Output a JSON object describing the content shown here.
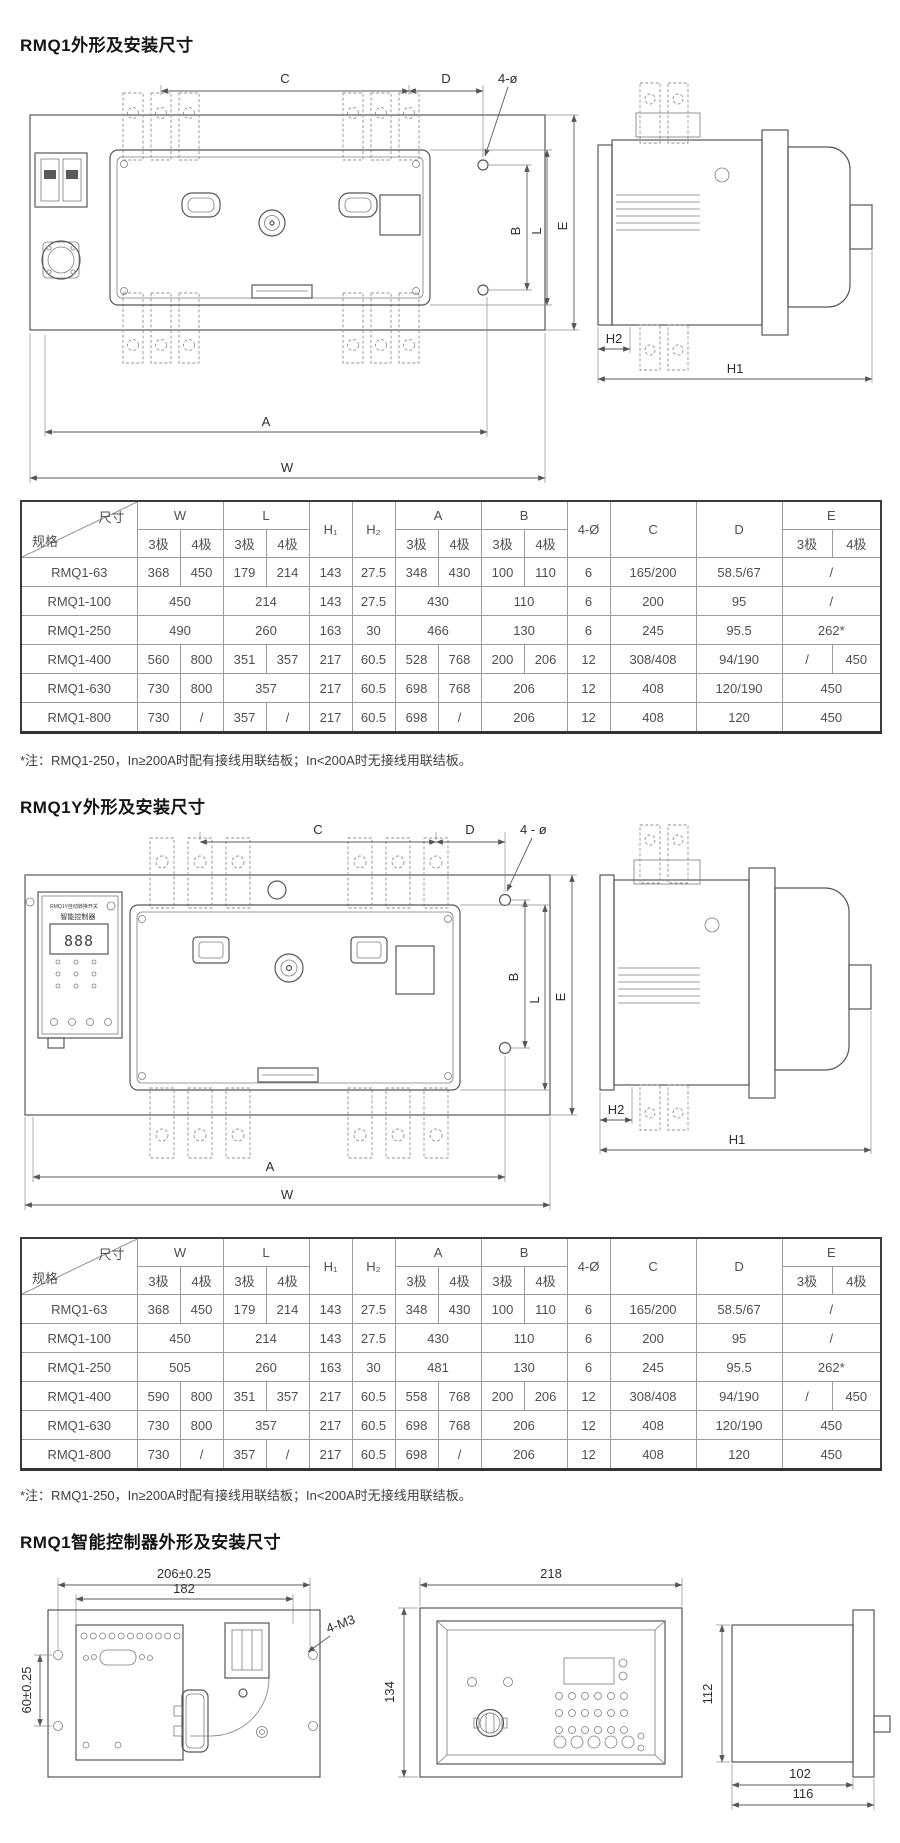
{
  "titles": {
    "section1": "RMQ1外形及安装尺寸",
    "section2": "RMQ1Y外形及安装尺寸",
    "section3": "RMQ1智能控制器外形及安装尺寸"
  },
  "notes": {
    "note1": "*注：RMQ1-250，In≥200A时配有接线用联结板；In<200A时无接线用联结板。",
    "note2": "*注：RMQ1-250，In≥200A时配有接线用联结板；In<200A时无接线用联结板。"
  },
  "table_header": {
    "corner_dim": "尺寸",
    "corner_spec": "规格",
    "w": "W",
    "l": "L",
    "h1": "H₁",
    "h2": "H₂",
    "a": "A",
    "b": "B",
    "phi": "4-Ø",
    "c": "C",
    "d": "D",
    "e": "E",
    "p3": "3极",
    "p4": "4极"
  },
  "table1": {
    "rows": [
      {
        "spec": "RMQ1-63",
        "cells": [
          "368",
          "450",
          "179",
          "214",
          "143",
          "27.5",
          "348",
          "430",
          "100",
          "110",
          "6",
          "165/200",
          "58.5/67",
          [
            "/",
            2
          ]
        ]
      },
      {
        "spec": "RMQ1-100",
        "cells": [
          [
            "450",
            2
          ],
          [
            "214",
            2
          ],
          "143",
          "27.5",
          [
            "430",
            2
          ],
          [
            "110",
            2
          ],
          "6",
          "200",
          "95",
          [
            "/",
            2
          ]
        ]
      },
      {
        "spec": "RMQ1-250",
        "cells": [
          [
            "490",
            2
          ],
          [
            "260",
            2
          ],
          "163",
          "30",
          [
            "466",
            2
          ],
          [
            "130",
            2
          ],
          "6",
          "245",
          "95.5",
          [
            "262*",
            2
          ]
        ]
      },
      {
        "spec": "RMQ1-400",
        "cells": [
          "560",
          "800",
          "351",
          "357",
          "217",
          "60.5",
          "528",
          "768",
          "200",
          "206",
          "12",
          "308/408",
          "94/190",
          "/",
          "450"
        ]
      },
      {
        "spec": "RMQ1-630",
        "cells": [
          "730",
          "800",
          [
            "357",
            2
          ],
          "217",
          "60.5",
          "698",
          "768",
          [
            "206",
            2
          ],
          "12",
          "408",
          "120/190",
          [
            "450",
            2
          ]
        ]
      },
      {
        "spec": "RMQ1-800",
        "cells": [
          "730",
          "/",
          "357",
          "/",
          "217",
          "60.5",
          "698",
          "/",
          [
            "206",
            2
          ],
          "12",
          "408",
          "120",
          [
            "450",
            2
          ]
        ]
      }
    ]
  },
  "table2": {
    "rows": [
      {
        "spec": "RMQ1-63",
        "cells": [
          "368",
          "450",
          "179",
          "214",
          "143",
          "27.5",
          "348",
          "430",
          "100",
          "110",
          "6",
          "165/200",
          "58.5/67",
          [
            "/",
            2
          ]
        ]
      },
      {
        "spec": "RMQ1-100",
        "cells": [
          [
            "450",
            2
          ],
          [
            "214",
            2
          ],
          "143",
          "27.5",
          [
            "430",
            2
          ],
          [
            "110",
            2
          ],
          "6",
          "200",
          "95",
          [
            "/",
            2
          ]
        ]
      },
      {
        "spec": "RMQ1-250",
        "cells": [
          [
            "505",
            2
          ],
          [
            "260",
            2
          ],
          "163",
          "30",
          [
            "481",
            2
          ],
          [
            "130",
            2
          ],
          "6",
          "245",
          "95.5",
          [
            "262*",
            2
          ]
        ]
      },
      {
        "spec": "RMQ1-400",
        "cells": [
          "590",
          "800",
          "351",
          "357",
          "217",
          "60.5",
          "558",
          "768",
          "200",
          "206",
          "12",
          "308/408",
          "94/190",
          "/",
          "450"
        ]
      },
      {
        "spec": "RMQ1-630",
        "cells": [
          "730",
          "800",
          [
            "357",
            2
          ],
          "217",
          "60.5",
          "698",
          "768",
          [
            "206",
            2
          ],
          "12",
          "408",
          "120/190",
          [
            "450",
            2
          ]
        ]
      },
      {
        "spec": "RMQ1-800",
        "cells": [
          "730",
          "/",
          "357",
          "/",
          "217",
          "60.5",
          "698",
          "/",
          [
            "206",
            2
          ],
          "12",
          "408",
          "120",
          [
            "450",
            2
          ]
        ]
      }
    ]
  },
  "drawing1": {
    "c": "C",
    "d": "D",
    "phi": "4-ø",
    "b": "B",
    "l": "L",
    "e": "E",
    "a": "A",
    "w": "W",
    "h2": "H2",
    "h1": "H1"
  },
  "drawing2": {
    "c": "C",
    "d": "D",
    "phi": "4 - ø",
    "b": "B",
    "l": "L",
    "e": "E",
    "a": "A",
    "w": "W",
    "h2": "H2",
    "h1": "H1"
  },
  "controller_box": {
    "line1": "RMQ1Y自动转换开关",
    "line2": "智能控制器",
    "display": "888"
  },
  "drawing3": {
    "d206": "206±0.25",
    "d182": "182",
    "d60": "60±0.25",
    "m3": "4-M3",
    "d218": "218",
    "d134": "134",
    "d112": "112",
    "d102": "102",
    "d116": "116"
  }
}
